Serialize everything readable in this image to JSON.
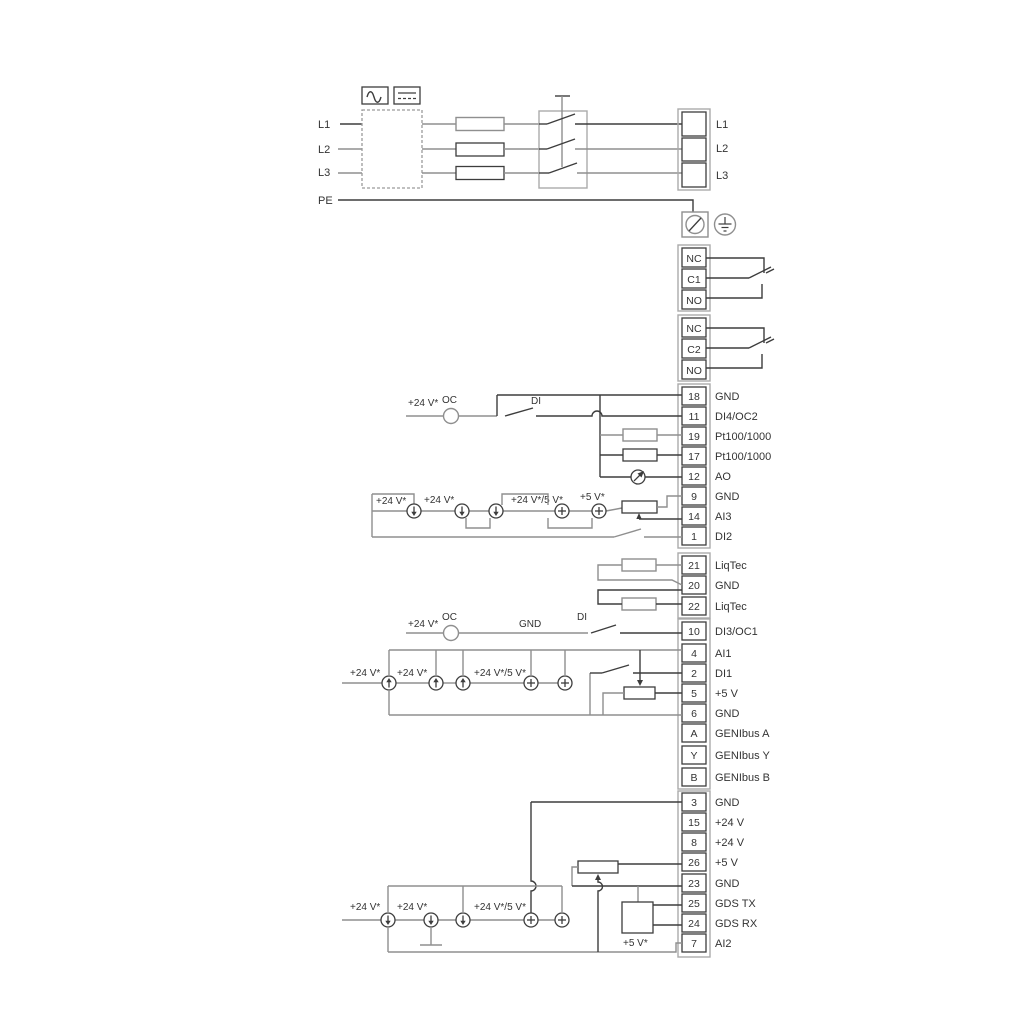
{
  "power": {
    "inputs": [
      "L1",
      "L2",
      "L3"
    ],
    "pe": "PE",
    "output_block": [
      "L1",
      "L2",
      "L3"
    ]
  },
  "relays": {
    "r1": [
      "NC",
      "C1",
      "NO"
    ],
    "r2": [
      "NC",
      "C2",
      "NO"
    ]
  },
  "strips": {
    "io1": [
      {
        "num": "18",
        "label": "GND"
      },
      {
        "num": "11",
        "label": "DI4/OC2"
      },
      {
        "num": "19",
        "label": "Pt100/1000"
      },
      {
        "num": "17",
        "label": "Pt100/1000"
      },
      {
        "num": "12",
        "label": "AO"
      },
      {
        "num": "9",
        "label": "GND"
      },
      {
        "num": "14",
        "label": "AI3"
      },
      {
        "num": "1",
        "label": "DI2"
      }
    ],
    "liqtec": [
      {
        "num": "21",
        "label": "LiqTec"
      },
      {
        "num": "20",
        "label": "GND"
      },
      {
        "num": "22",
        "label": "LiqTec"
      }
    ],
    "io2": [
      {
        "num": "10",
        "label": "DI3/OC1"
      },
      {
        "num": "4",
        "label": "AI1"
      },
      {
        "num": "2",
        "label": "DI1"
      },
      {
        "num": "5",
        "label": "+5 V"
      },
      {
        "num": "6",
        "label": "GND"
      },
      {
        "num": "A",
        "label": "GENIbus A"
      },
      {
        "num": "Y",
        "label": "GENIbus Y"
      },
      {
        "num": "B",
        "label": "GENIbus B"
      }
    ],
    "io3": [
      {
        "num": "3",
        "label": "GND"
      },
      {
        "num": "15",
        "label": "+24 V"
      },
      {
        "num": "8",
        "label": "+24 V"
      },
      {
        "num": "26",
        "label": "+5 V"
      },
      {
        "num": "23",
        "label": "GND"
      },
      {
        "num": "25",
        "label": "GDS TX"
      },
      {
        "num": "24",
        "label": "GDS RX"
      },
      {
        "num": "7",
        "label": "AI2"
      }
    ]
  },
  "annotations": {
    "v24": "+24 V*",
    "v24_5": "+24 V*/5 V*",
    "v5": "+5 V*",
    "oc": "OC",
    "di": "DI",
    "gnd": "GND"
  },
  "colors": {
    "wire_gray": "#8f8f8f",
    "wire_dark": "#3d3d3d",
    "text": "#333333"
  }
}
